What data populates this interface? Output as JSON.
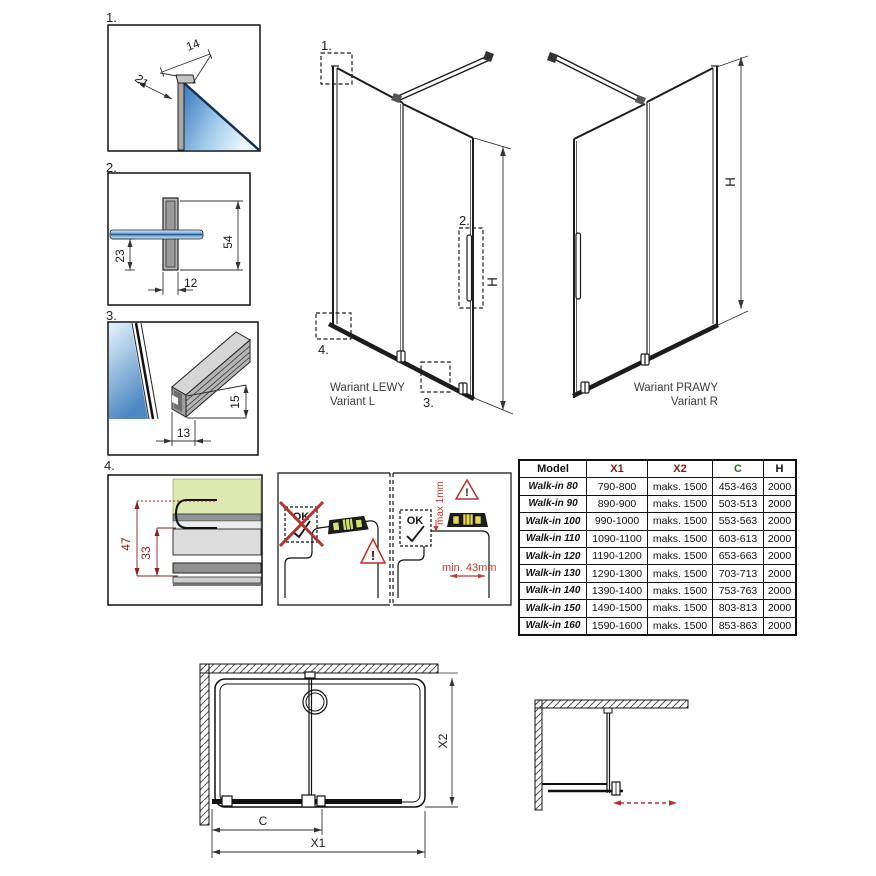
{
  "details": {
    "d1": {
      "label": "1.",
      "dim_width": "14",
      "dim_depth": "21"
    },
    "d2": {
      "label": "2.",
      "dim_total": "54",
      "dim_offset": "23",
      "dim_width": "12"
    },
    "d3": {
      "label": "3.",
      "dim_width": "13",
      "dim_height": "15"
    },
    "d4": {
      "label": "4.",
      "dim_total": "47",
      "dim_inner": "33"
    }
  },
  "elevations": {
    "left": {
      "title": "Wariant LEWY",
      "subtitle": "Variant L",
      "height_label": "H",
      "callout_1": "1.",
      "callout_2": "2.",
      "callout_3": "3.",
      "callout_4": "4."
    },
    "right": {
      "title": "Wariant PRAWY",
      "subtitle": "Variant R",
      "height_label": "H"
    }
  },
  "install": {
    "not_ok_label": "OK",
    "ok_label": "OK",
    "warning_mark": "!",
    "max_gap": "max 1mm",
    "min_width": "min. 43mm"
  },
  "table": {
    "headers": {
      "model": "Model",
      "x1": "X1",
      "x2": "X2",
      "c": "C",
      "h": "H"
    },
    "rows": [
      {
        "model": "Walk-in 80",
        "x1": "790-800",
        "x2": "maks. 1500",
        "c": "453-463",
        "h": "2000"
      },
      {
        "model": "Walk-in 90",
        "x1": "890-900",
        "x2": "maks. 1500",
        "c": "503-513",
        "h": "2000"
      },
      {
        "model": "Walk-in 100",
        "x1": "990-1000",
        "x2": "maks. 1500",
        "c": "553-563",
        "h": "2000"
      },
      {
        "model": "Walk-in 110",
        "x1": "1090-1100",
        "x2": "maks. 1500",
        "c": "603-613",
        "h": "2000"
      },
      {
        "model": "Walk-in 120",
        "x1": "1190-1200",
        "x2": "maks. 1500",
        "c": "653-663",
        "h": "2000"
      },
      {
        "model": "Walk-in 130",
        "x1": "1290-1300",
        "x2": "maks. 1500",
        "c": "703-713",
        "h": "2000"
      },
      {
        "model": "Walk-in 140",
        "x1": "1390-1400",
        "x2": "maks. 1500",
        "c": "753-763",
        "h": "2000"
      },
      {
        "model": "Walk-in 150",
        "x1": "1490-1500",
        "x2": "maks. 1500",
        "c": "803-813",
        "h": "2000"
      },
      {
        "model": "Walk-in 160",
        "x1": "1590-1600",
        "x2": "maks. 1500",
        "c": "853-863",
        "h": "2000"
      }
    ]
  },
  "plan": {
    "dim_c": "C",
    "dim_x1": "X1",
    "dim_x2": "X2"
  },
  "colors": {
    "accent_red": "#b23430",
    "dim_red": "#8b2020",
    "dim_green": "#3f7f3f",
    "table_x": "#7a1f1f",
    "table_c": "#2f6b2f",
    "glass_blue": "#3f7ec0"
  }
}
